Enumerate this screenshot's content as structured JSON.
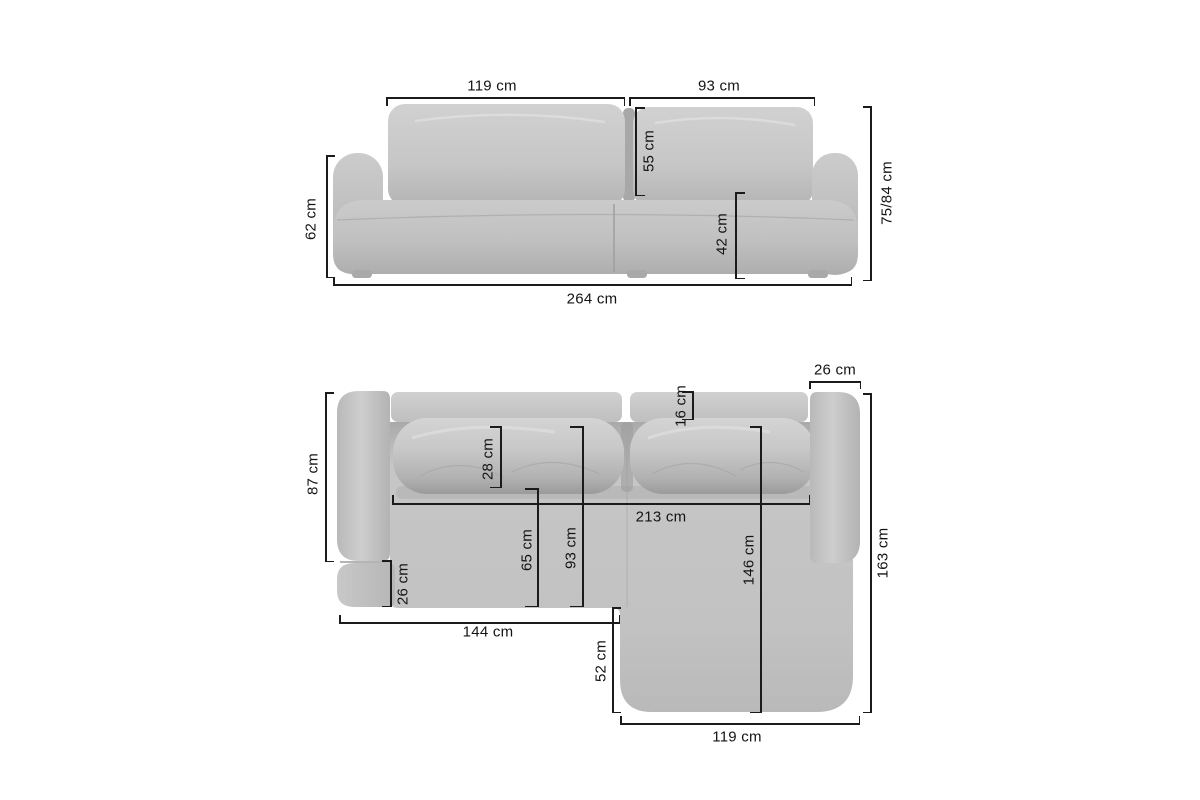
{
  "front_view": {
    "dims": {
      "back_left_width": "119 cm",
      "back_right_width": "93 cm",
      "back_cushion_height": "55 cm",
      "seat_height": "42 cm",
      "armrest_height": "62 cm",
      "total_height": "75/84 cm",
      "total_width": "264 cm"
    }
  },
  "top_view": {
    "dims": {
      "right_armrest_width": "26 cm",
      "backrest_depth": "16 cm",
      "armrest_length": "87 cm",
      "back_cushion_depth": "28 cm",
      "inner_width": "213 cm",
      "seat_depth": "65 cm",
      "seat_depth_total": "93 cm",
      "chaise_seat_length": "146 cm",
      "front_corner_depth": "26 cm",
      "left_section_length": "144 cm",
      "chaise_extension": "52 cm",
      "total_depth": "163 cm",
      "chaise_width": "119 cm"
    }
  }
}
